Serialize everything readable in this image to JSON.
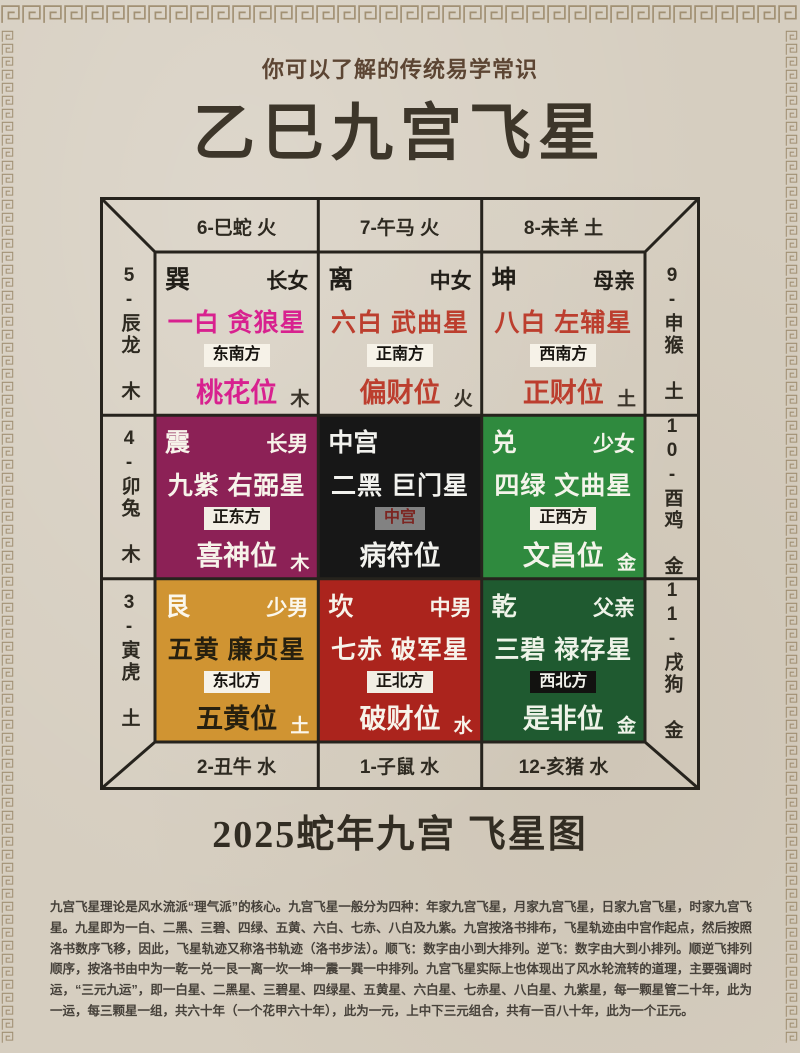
{
  "page": {
    "subtitle": "你可以了解的传统易学常识",
    "title": "乙巳九宫飞星",
    "caption": "2025蛇年九宫 飞星图",
    "paragraph": "九宫飞星理论是风水流派“理气派”的核心。九宫飞星一般分为四种：年家九宫飞星，月家九宫飞星，日家九宫飞星，时家九宫飞星。九星即为一白、二黑、三碧、四绿、五黄、六白、七赤、八白及九紫。九宫按洛书排布，飞星轨迹由中宫作起点，然后按照洛书数序飞移，因此，飞星轨迹又称洛书轨迹（洛书步法）。顺飞：数字由小到大排列。逆飞：数字由大到小排列。顺逆飞排列顺序，按洛书由中为一乾一兑一艮一离一坎一坤一震一巽一中排列。九宫飞星实际上也体现出了风水轮流转的道理，主要强调时运，“三元九运”，即一白星、二黑星、三碧星、四绿星、五黄星、六白星、七赤星、八白星、九紫星，每一颗星管二十年，此为一运，每三颗星一组，共六十年（一个花甲六十年），此为一元，上中下三元组合，共有一百八十年，此为一个正元。"
  },
  "colors": {
    "paper": "#d6cec0",
    "ink": "#3d362a",
    "frame_line": "#26231d",
    "meander": "#8f7b59"
  },
  "frame": {
    "top_labels": [
      "6-巳蛇 火",
      "7-午马 火",
      "8-未羊 土"
    ],
    "bottom_labels": [
      "2-丑牛 水",
      "1-子鼠 水",
      "12-亥猪 水"
    ],
    "left_labels": [
      "5-辰龙 木",
      "4-卯兔 木",
      "3-寅虎 土"
    ],
    "right_labels": [
      "9-申猴 土",
      "10-酉鸡 金",
      "11-戌狗 金"
    ]
  },
  "grid": {
    "cells": [
      {
        "trigram": "巽",
        "person": "长女",
        "star": "一白 贪狼星",
        "direction": "东南方",
        "position": "桃花位",
        "meaning": "主感情、人缘",
        "element": "木",
        "bg": "transparent",
        "header_fg": "#211e18",
        "star_fg": "#d8218f",
        "position_fg": "#d8218f",
        "element_fg": "#3a342a",
        "badge_bg": "#f6f2e8",
        "badge_fg": "#16130f"
      },
      {
        "trigram": "离",
        "person": "中女",
        "star": "六白 武曲星",
        "direction": "正南方",
        "position": "偏财位",
        "meaning": "主横财、贵人",
        "element": "火",
        "bg": "transparent",
        "header_fg": "#211e18",
        "star_fg": "#bc3e2e",
        "position_fg": "#bc3e2e",
        "element_fg": "#3a342a",
        "badge_bg": "#f6f2e8",
        "badge_fg": "#16130f"
      },
      {
        "trigram": "坤",
        "person": "母亲",
        "star": "八白 左辅星",
        "direction": "西南方",
        "position": "正财位",
        "meaning": "主财运、置业",
        "element": "土",
        "bg": "transparent",
        "header_fg": "#211e18",
        "star_fg": "#bc3e2e",
        "position_fg": "#bc3e2e",
        "element_fg": "#3a342a",
        "badge_bg": "#f6f2e8",
        "badge_fg": "#16130f"
      },
      {
        "trigram": "震",
        "person": "长男",
        "star": "九紫 右弼星",
        "direction": "正东方",
        "position": "喜神位",
        "meaning": "主姻缘、感情",
        "element": "木",
        "bg": "#8c2156",
        "header_fg": "#f7f3ea",
        "star_fg": "#f7f3ea",
        "position_fg": "#f7f3ea",
        "element_fg": "#f7f3ea",
        "badge_bg": "#f2eee4",
        "badge_fg": "#1c1812"
      },
      {
        "trigram": "中宫",
        "person": "",
        "star": "二黑 巨门星",
        "direction": "中宫",
        "position": "病符位",
        "meaning": "主疾病、伤痛",
        "element": "",
        "bg": "#171717",
        "header_fg": "#f2f2ee",
        "star_fg": "#f2f2ee",
        "position_fg": "#f2f2ee",
        "element_fg": "#f2f2ee",
        "badge_bg": "#828282",
        "badge_fg": "#7c2521"
      },
      {
        "trigram": "兑",
        "person": "少女",
        "star": "四绿 文曲星",
        "direction": "正西方",
        "position": "文昌位",
        "meaning": "主事业、学业",
        "element": "金",
        "bg": "#2f8a3e",
        "header_fg": "#f4f4ea",
        "star_fg": "#f4f4ea",
        "position_fg": "#f4f4ea",
        "element_fg": "#f4f4ea",
        "badge_bg": "#f2eee4",
        "badge_fg": "#1c1812"
      },
      {
        "trigram": "艮",
        "person": "少男",
        "star": "五黄 廉贞星",
        "direction": "东北方",
        "position": "五黄位",
        "meaning": "主凶灾、祸患",
        "element": "土",
        "bg": "#d09432",
        "header_fg": "#fbf7ec",
        "star_fg": "#27200f",
        "position_fg": "#27200f",
        "element_fg": "#fbf7ec",
        "badge_bg": "#f6f2e8",
        "badge_fg": "#16130f"
      },
      {
        "trigram": "坎",
        "person": "中男",
        "star": "七赤 破军星",
        "direction": "正北方",
        "position": "破财位",
        "meaning": "主破财、败运",
        "element": "水",
        "bg": "#ab241d",
        "header_fg": "#f7f3ea",
        "star_fg": "#f7f3ea",
        "position_fg": "#f7f3ea",
        "element_fg": "#f7f3ea",
        "badge_bg": "#f2eee4",
        "badge_fg": "#1c1812"
      },
      {
        "trigram": "乾",
        "person": "父亲",
        "star": "三碧 禄存星",
        "direction": "西北方",
        "position": "是非位",
        "meaning": "主是非、官灾",
        "element": "金",
        "bg": "#1f5a30",
        "header_fg": "#eef3e8",
        "star_fg": "#eef3e8",
        "position_fg": "#eef3e8",
        "element_fg": "#eef3e8",
        "badge_bg": "#121210",
        "badge_fg": "#f2f2ec"
      }
    ]
  }
}
